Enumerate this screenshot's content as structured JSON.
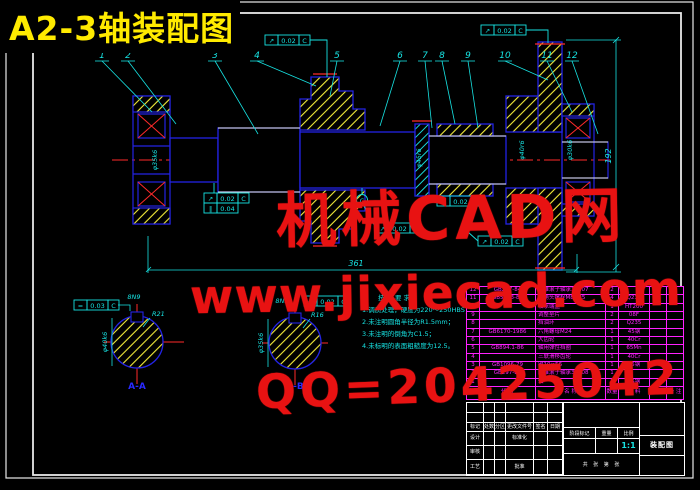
{
  "title": "A2-3轴装配图",
  "watermarks": {
    "site_name": "机械CAD网",
    "url": "www.jixiecad.com",
    "qq": "QQ=20425042"
  },
  "parts": [
    "1",
    "2",
    "3",
    "4",
    "5",
    "6",
    "7",
    "8",
    "9",
    "10",
    "11",
    "12"
  ],
  "dims": {
    "overall": "361",
    "gear_od": "192",
    "left_journal": "φ35k6",
    "collar": "φ45r6",
    "hub": "φ40r6",
    "right_journal": "φ30k6"
  },
  "datum": "C",
  "frames": {
    "f1": {
      "sym": "↗",
      "val": "0.02",
      "datum": "C"
    },
    "f2": {
      "sym": "↗",
      "val": "0.02",
      "datum": "C"
    },
    "f3a": {
      "sym": "↗",
      "val": "0.02",
      "datum": "C"
    },
    "f3b": {
      "sym": "∥",
      "val": "0.04"
    },
    "f4": {
      "sym": "↗",
      "val": "0.02",
      "datum": "C"
    },
    "f5": {
      "sym": "↗",
      "val": "0.02",
      "datum": "C"
    },
    "f6": {
      "sym": "↗",
      "val": "0.02",
      "datum": "C"
    },
    "fa": {
      "sym": "=",
      "val": "0.03",
      "datum": "C"
    },
    "fb": {
      "sym": "=",
      "val": "0.02",
      "datum": "C"
    }
  },
  "sectionA": {
    "label": "A-A",
    "dia": "φ40k6",
    "key": "8N9",
    "radius": "R21"
  },
  "sectionB": {
    "label": "B-B",
    "dia": "φ35k6",
    "key": "8N9",
    "radius": "R16"
  },
  "notes": {
    "header": "技术要求",
    "items": [
      "1.调质处理，硬度为220～250HBS；",
      "2.未注明圆角半径为R1.5mm；",
      "3.未注明的倒角为C1.5；",
      "4.未标明的表面粗糙度为12.5。"
    ]
  },
  "bom": {
    "headers": [
      "序号",
      "代 号",
      "名 称",
      "数量",
      "材 料",
      "重量",
      "备 注"
    ],
    "rows": [
      {
        "no": "12",
        "code": "GB297-84",
        "name": "圆锥滚子轴承30207",
        "qty": "2",
        "mat": "",
        "wt": "",
        "rem": ""
      },
      {
        "no": "11",
        "code": "GB5783-86",
        "name": "六角头螺栓M8×25",
        "qty": "4",
        "mat": "Q235",
        "wt": "",
        "rem": ""
      },
      {
        "no": "10",
        "code": "",
        "name": "轴承端盖",
        "qty": "1",
        "mat": "HT200",
        "wt": "",
        "rem": ""
      },
      {
        "no": "9",
        "code": "",
        "name": "调整垫片",
        "qty": "2",
        "mat": "08F",
        "wt": "",
        "rem": ""
      },
      {
        "no": "8",
        "code": "",
        "name": "挡油环",
        "qty": "2",
        "mat": "Q235",
        "wt": "",
        "rem": ""
      },
      {
        "no": "7",
        "code": "GB6170-1986",
        "name": "六角螺母M24",
        "qty": "1",
        "mat": "45钢",
        "wt": "",
        "rem": ""
      },
      {
        "no": "6",
        "code": "",
        "name": "大齿轮",
        "qty": "1",
        "mat": "40Cr",
        "wt": "",
        "rem": ""
      },
      {
        "no": "5",
        "code": "GB894.1-86",
        "name": "轴用弹性挡圈",
        "qty": "1",
        "mat": "65Mn",
        "wt": "",
        "rem": ""
      },
      {
        "no": "4",
        "code": "",
        "name": "三联滑移齿轮",
        "qty": "1",
        "mat": "40Cr",
        "wt": "",
        "rem": ""
      },
      {
        "no": "3",
        "code": "GB1096-79",
        "name": "键10×56",
        "qty": "1",
        "mat": "45钢",
        "wt": "",
        "rem": ""
      },
      {
        "no": "2",
        "code": "GB297-84",
        "name": "圆锥滚子轴承30208",
        "qty": "1",
        "mat": "",
        "wt": "",
        "rem": ""
      },
      {
        "no": "1",
        "code": "",
        "name": "轴",
        "qty": "1",
        "mat": "45钢",
        "wt": "",
        "rem": ""
      }
    ]
  },
  "tblock": {
    "rev_header": [
      "标记",
      "处数",
      "分区",
      "更改文件号",
      "签名",
      "日期"
    ],
    "roles": {
      "design": "设计",
      "check": "审核",
      "process": "工艺",
      "std": "标准化",
      "approve": "批准"
    },
    "stage": "阶段标记",
    "weight": "重量",
    "scale_label": "比例",
    "scale": "1:1",
    "sheets": "共 张 第 张",
    "doc_name": "装配图"
  }
}
